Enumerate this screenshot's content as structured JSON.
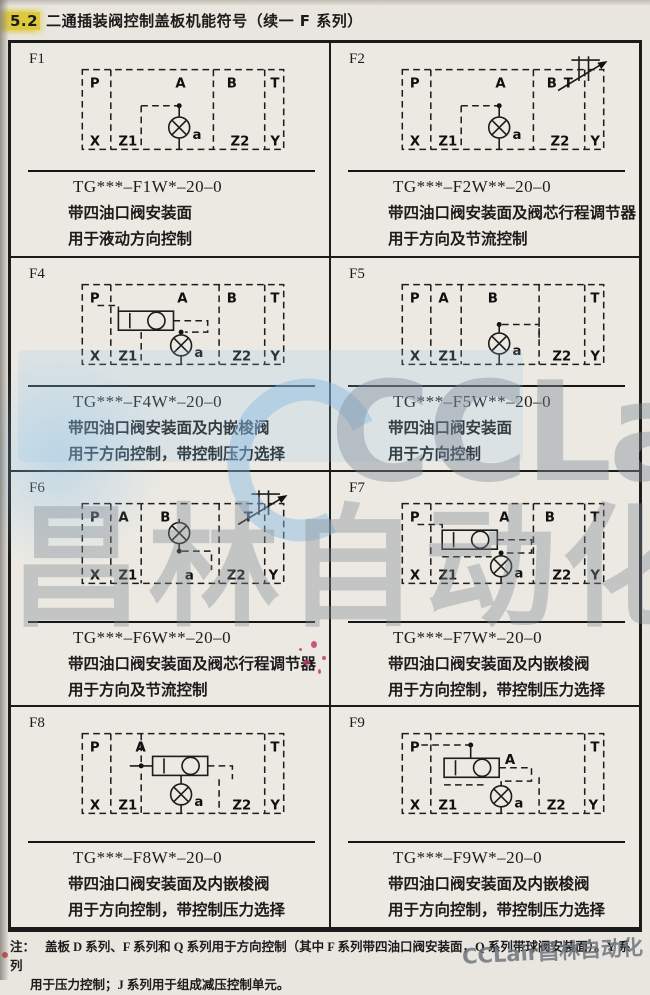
{
  "page": {
    "section": "5.2",
    "title": "二通插装阀控制盖板机能符号（续一  F 系列）",
    "note_label": "注：",
    "note_line1": "盖板 D 系列、F 系列和 Q 系列用于方向控制（其中 F 系列带四油口阀安装面，Q 系列带球阀安装面）。Y 系列",
    "note_line2": "用于压力控制；J 系列用于组成减压控制单元。",
    "watermark": {
      "brand_latin": "CCLair",
      "brand_cjk": "昌林自动化",
      "corner": "CCLair昌林自动化",
      "accent_blue": "#87b9e2",
      "gray": "#8c949c",
      "highlight_yellow": "#ddc83e"
    }
  },
  "cells": [
    {
      "id": "F1",
      "code": "TG***–F1W*–20–0",
      "desc1": "带四油口阀安装面",
      "desc2": "用于液动方向控制",
      "ports": {
        "p": "P",
        "a_top": "A",
        "b": "B",
        "t": "T",
        "x": "X",
        "z1": "Z1",
        "a": "a",
        "z2": "Z2",
        "y": "Y"
      }
    },
    {
      "id": "F2",
      "code": "TG***–F2W**–20–0",
      "desc1": "带四油口阀安装面及阀芯行程调节器",
      "desc2": "用于方向及节流控制",
      "ports": {
        "p": "P",
        "a_top": "A",
        "b": "B",
        "t": "T",
        "x": "X",
        "z1": "Z1",
        "a": "a",
        "z2": "Z2",
        "y": "Y"
      }
    },
    {
      "id": "F4",
      "code": "TG***–F4W*–20–0",
      "desc1": "带四油口阀安装面及内嵌梭阀",
      "desc2": "用于方向控制，带控制压力选择",
      "ports": {
        "p": "P",
        "a_top": "A",
        "b": "B",
        "t": "T",
        "x": "X",
        "z1": "Z1",
        "a": "a",
        "z2": "Z2",
        "y": "Y"
      }
    },
    {
      "id": "F5",
      "code": "TG***–F5W**–20–0",
      "desc1": "带四油口阀安装面",
      "desc2": "用于方向控制",
      "ports": {
        "p": "P",
        "a_top": "A",
        "b": "B",
        "t": "T",
        "x": "X",
        "z1": "Z1",
        "a": "a",
        "z2": "Z2",
        "y": "Y"
      }
    },
    {
      "id": "F6",
      "code": "TG***–F6W**–20–0",
      "desc1": "带四油口阀安装面及阀芯行程调节器",
      "desc2": "用于方向及节流控制",
      "ports": {
        "p": "P",
        "a_top": "A",
        "b": "B",
        "t": "T",
        "x": "X",
        "z1": "Z1",
        "a": "a",
        "z2": "Z2",
        "y": "Y"
      }
    },
    {
      "id": "F7",
      "code": "TG***–F7W*–20–0",
      "desc1": "带四油口阀安装面及内嵌梭阀",
      "desc2": "用于方向控制，带控制压力选择",
      "ports": {
        "p": "P",
        "a_top": "A",
        "b": "B",
        "t": "T",
        "x": "X",
        "z1": "Z1",
        "a": "a",
        "z2": "Z2",
        "y": "Y"
      }
    },
    {
      "id": "F8",
      "code": "TG***–F8W*–20–0",
      "desc1": "带四油口阀安装面及内嵌梭阀",
      "desc2": "用于方向控制，带控制压力选择",
      "ports": {
        "p": "P",
        "a_top": "A",
        "t": "T",
        "x": "X",
        "z1": "Z1",
        "a": "a",
        "z2": "Z2",
        "y": "Y"
      }
    },
    {
      "id": "F9",
      "code": "TG***–F9W*–20–0",
      "desc1": "带四油口阀安装面及内嵌梭阀",
      "desc2": "用于方向控制，带控制压力选择",
      "ports": {
        "p": "P",
        "a_top": "A",
        "t": "T",
        "x": "X",
        "z1": "Z1",
        "a": "a",
        "z2": "Z2",
        "y": "Y"
      }
    }
  ]
}
